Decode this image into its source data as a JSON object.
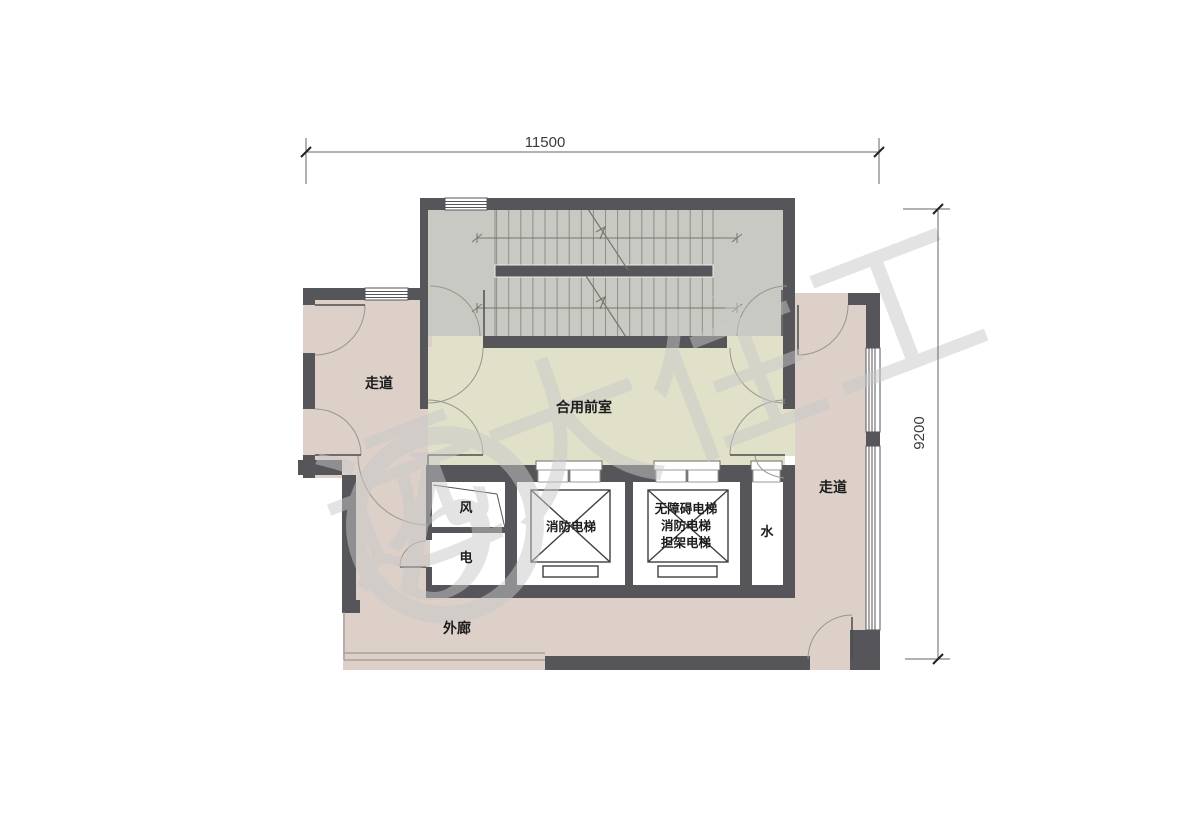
{
  "floor_plan": {
    "dimensions": {
      "width": "11500",
      "height": "9200"
    },
    "rooms": {
      "corridor_left": "走道",
      "corridor_right": "走道",
      "shared_lobby": "合用前室",
      "outer_corridor": "外廊",
      "air_shaft": "风",
      "electrical_shaft": "电",
      "water_shaft": "水",
      "fire_elevator": "消防电梯",
      "combo_elevator_line1": "无障碍电梯",
      "combo_elevator_line2": "消防电梯",
      "combo_elevator_line3": "担架电梯"
    },
    "watermark": {
      "logo": "b",
      "text": "远大住工"
    },
    "colors": {
      "wall": "#56565a",
      "corridor": "#ddd0c9",
      "lobby": "#e1e0c9",
      "stair": "#c9c9c3"
    }
  }
}
